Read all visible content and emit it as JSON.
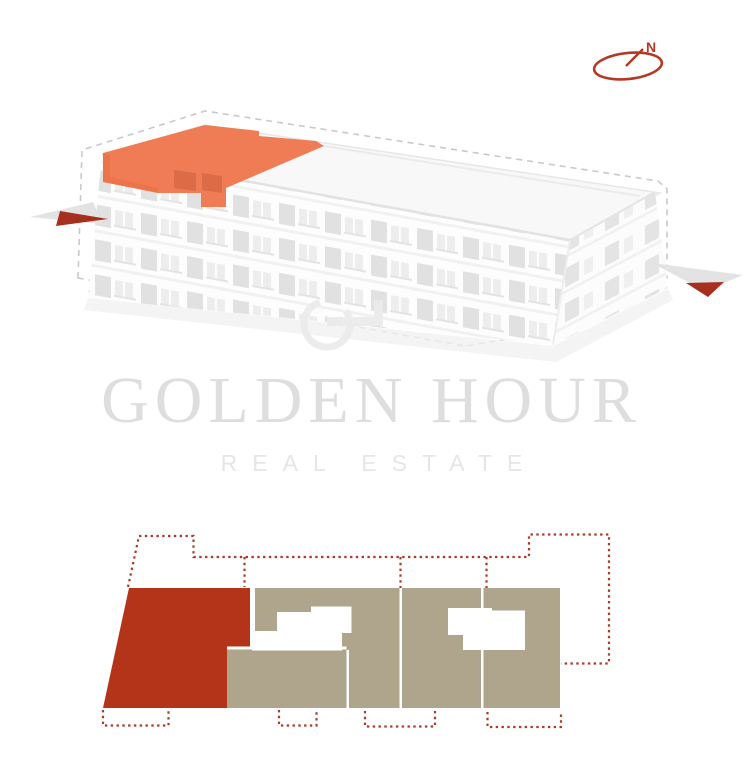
{
  "brand": {
    "name": "GOLDEN HOUR",
    "tagline": "REAL ESTATE"
  },
  "compass": {
    "label": "N"
  },
  "colors": {
    "accent-orange": "#ef7c54",
    "accent-orange-dark": "#db6c47",
    "plan-red": "#b43419",
    "plan-tan": "#aea58c",
    "dotted-red": "#a83c28",
    "arrow-red": "#a72f1d",
    "compass-red": "#b33a24",
    "watermark-gray": "#dedede",
    "tagline-gray": "#e6e6e6",
    "dash-gray": "#c9c9c9"
  },
  "building_view": {
    "highlighted_unit": "top-floor-left-section",
    "highlight_state": "selected"
  },
  "floor_plan": {
    "units": [
      {
        "id": "unit-1",
        "state": "selected"
      },
      {
        "id": "unit-2",
        "state": "default"
      },
      {
        "id": "unit-3",
        "state": "default"
      },
      {
        "id": "unit-4",
        "state": "default"
      }
    ]
  },
  "icons": {
    "compass": "compass-north-icon",
    "logo": "g-monogram-icon",
    "arrows": "entrance-arrow-icon"
  }
}
